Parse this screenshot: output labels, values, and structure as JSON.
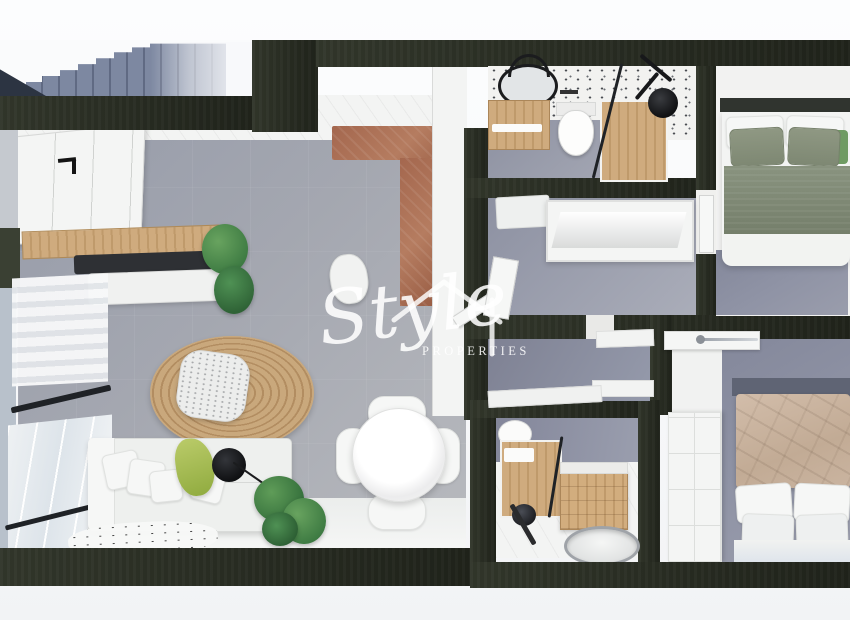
{
  "watermark": {
    "script": "Style",
    "caps": "PROPERTIES",
    "icon": "house-outline-icon",
    "color": "#ffffff"
  },
  "palette": {
    "wall": "#262a20",
    "floor": "#a2a5ad",
    "carpet": "#8c90a2",
    "wood": "#cfab7e",
    "rust": "#a4674e",
    "sofa": "#eff0ee",
    "plant": "#4e8b50",
    "throw": "#a9bf56",
    "jute": "#c2a074",
    "stairs": "#7d88a1",
    "sage": "#8a9383",
    "tan": "#cbb6a4",
    "glass": "#dde4ea",
    "background": "#f7f8fa"
  }
}
